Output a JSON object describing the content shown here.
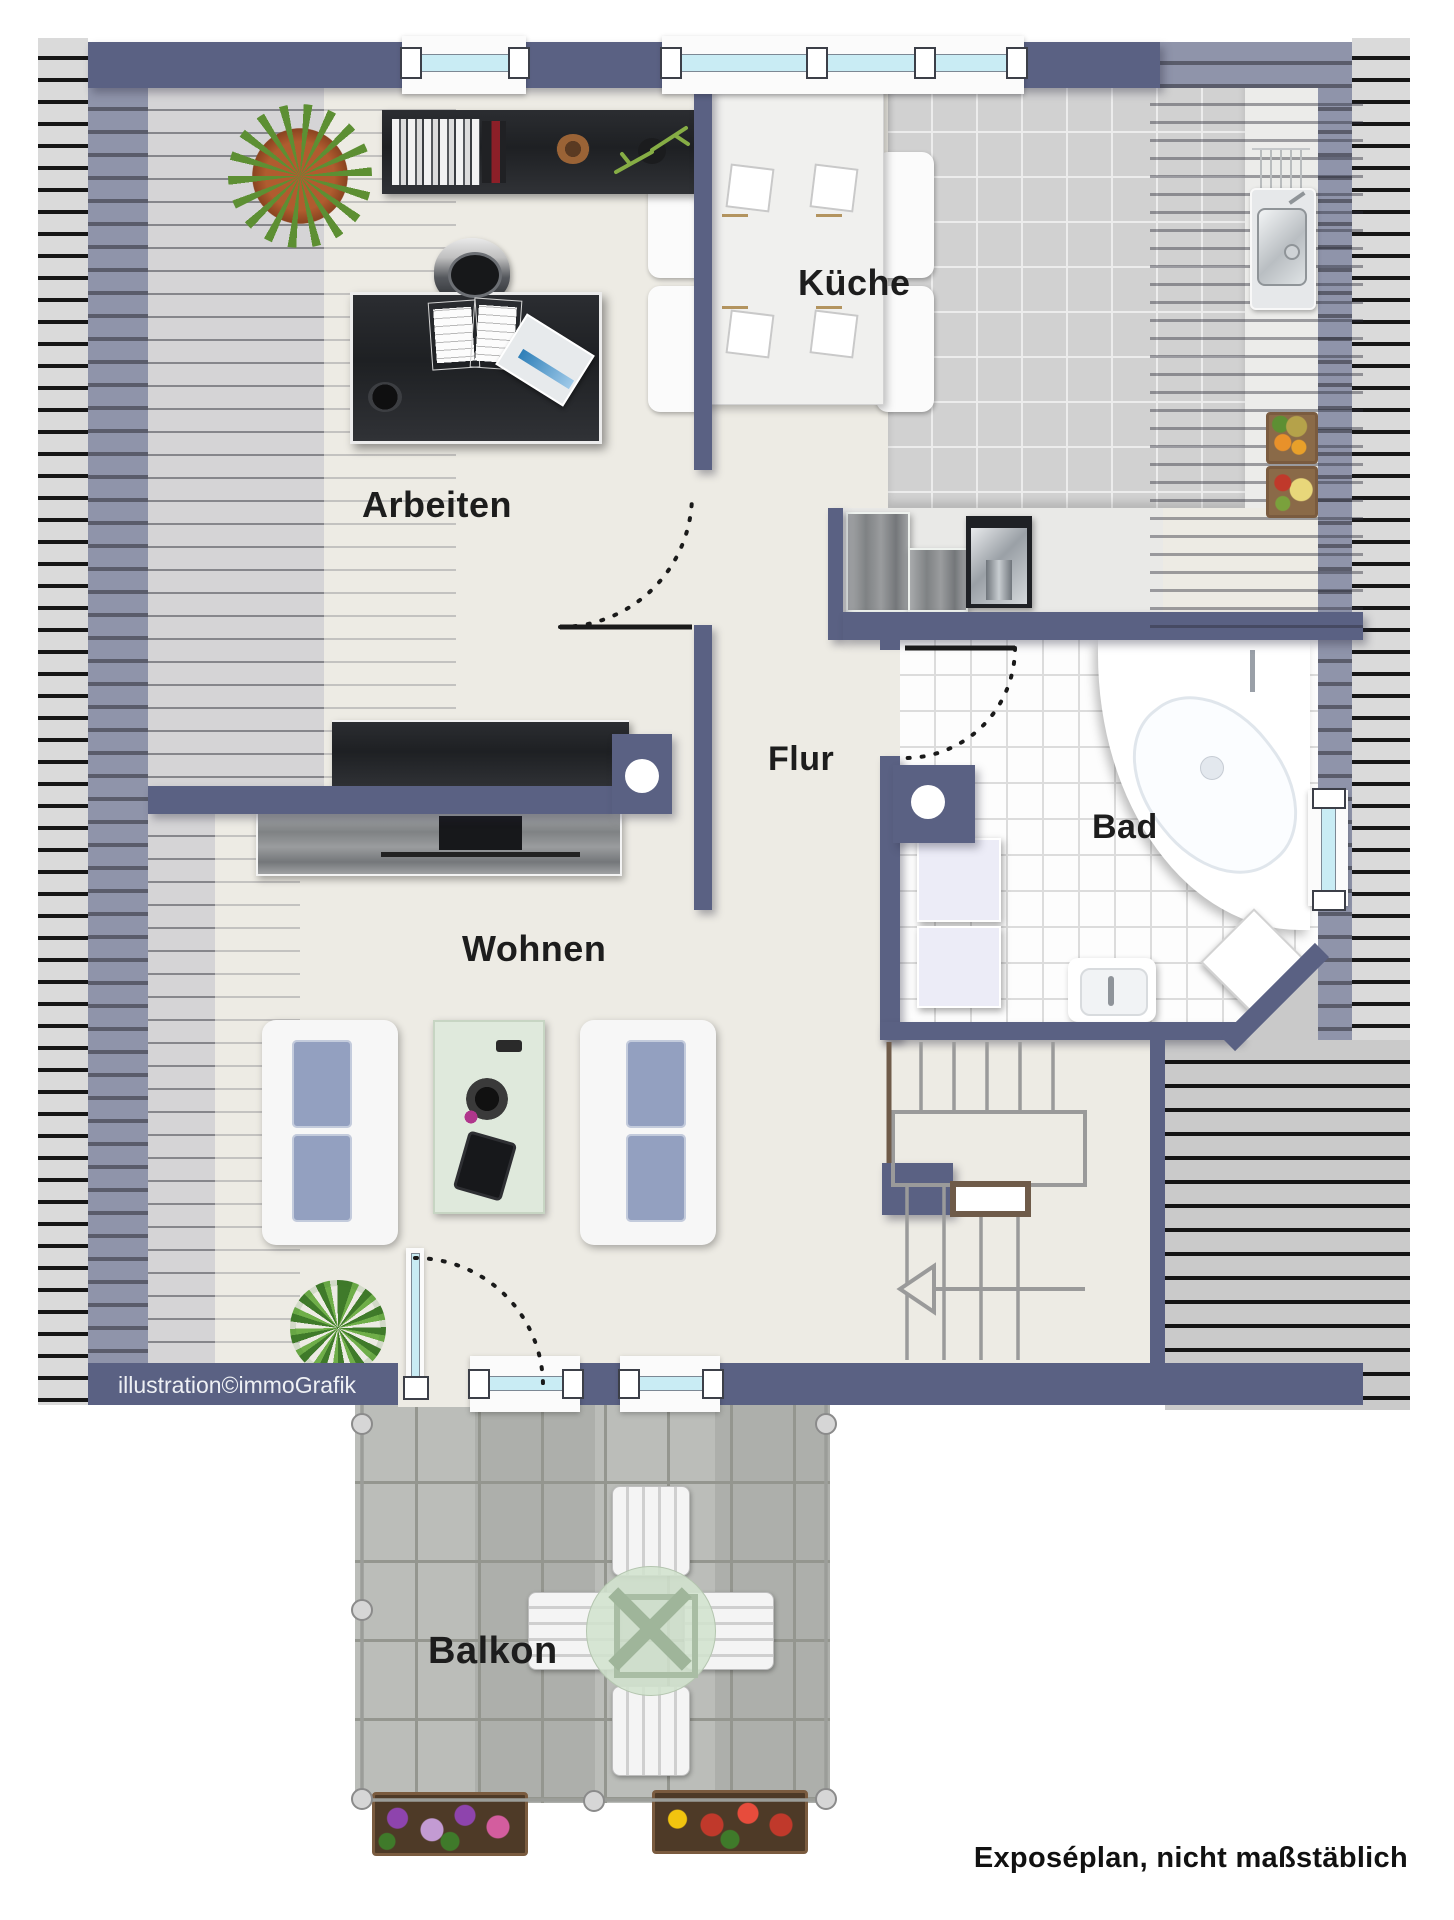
{
  "rooms": {
    "arbeiten": "Arbeiten",
    "kueche": "Küche",
    "flur": "Flur",
    "bad": "Bad",
    "wohnen": "Wohnen",
    "balkon": "Balkon"
  },
  "credits": {
    "illustration": "illustration©immoGrafik",
    "disclaimer": "Exposéplan, nicht maßstäblich"
  },
  "colors": {
    "wall": "#5a6183",
    "wall_translucent": "#8f94aa",
    "floor": "#edebe4",
    "kitchen_tile": "#d1d1d1",
    "bath_tile": "#fdfdfd",
    "roof_stripe_bg": "#dadada",
    "roof_stripe_line": "#161616",
    "balcony_paver": "#b6b8b4",
    "sofa_cushion": "#93a0c0",
    "glass_table": "#dfe9dc",
    "dark_furniture": "#26282c",
    "handrail": "#6f5b49"
  }
}
